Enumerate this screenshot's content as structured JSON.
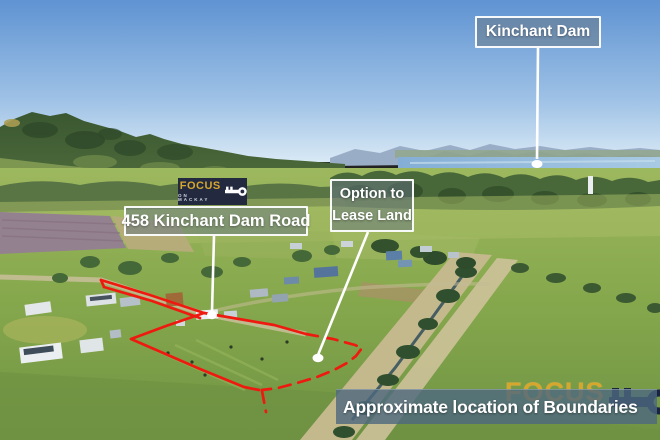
{
  "photo": {
    "type": "aerial-drone-photo",
    "scene": "Rural acreage property with green paddocks, forested mountain range at left, Kinchant Dam on the horizon, houses and sheds, and an irrigation channel"
  },
  "annotations": {
    "dam_label": {
      "text": "Kinchant Dam"
    },
    "address_label": {
      "text": "458 Kinchant Dam Road"
    },
    "lease_label": {
      "line1": "Option to",
      "line2": "Lease Land"
    },
    "disclaimer_bar": {
      "text": "Approximate location of Boundaries"
    }
  },
  "brand": {
    "name": "FOCUS",
    "tagline": "ON MACKAY",
    "icon": "key-icon"
  },
  "colors": {
    "boundary_red": "#ee1a10",
    "brand_gold": "#d7a62c",
    "brand_navy": "#232a40",
    "watermark_navy": "#18233f",
    "marker_white": "#ffffff",
    "bar_bg": "rgba(78,104,127,0.8)",
    "label_bg": "rgba(104,118,130,0.52)",
    "sky_blue": "#6094d2",
    "field_green": "#85a74c"
  }
}
